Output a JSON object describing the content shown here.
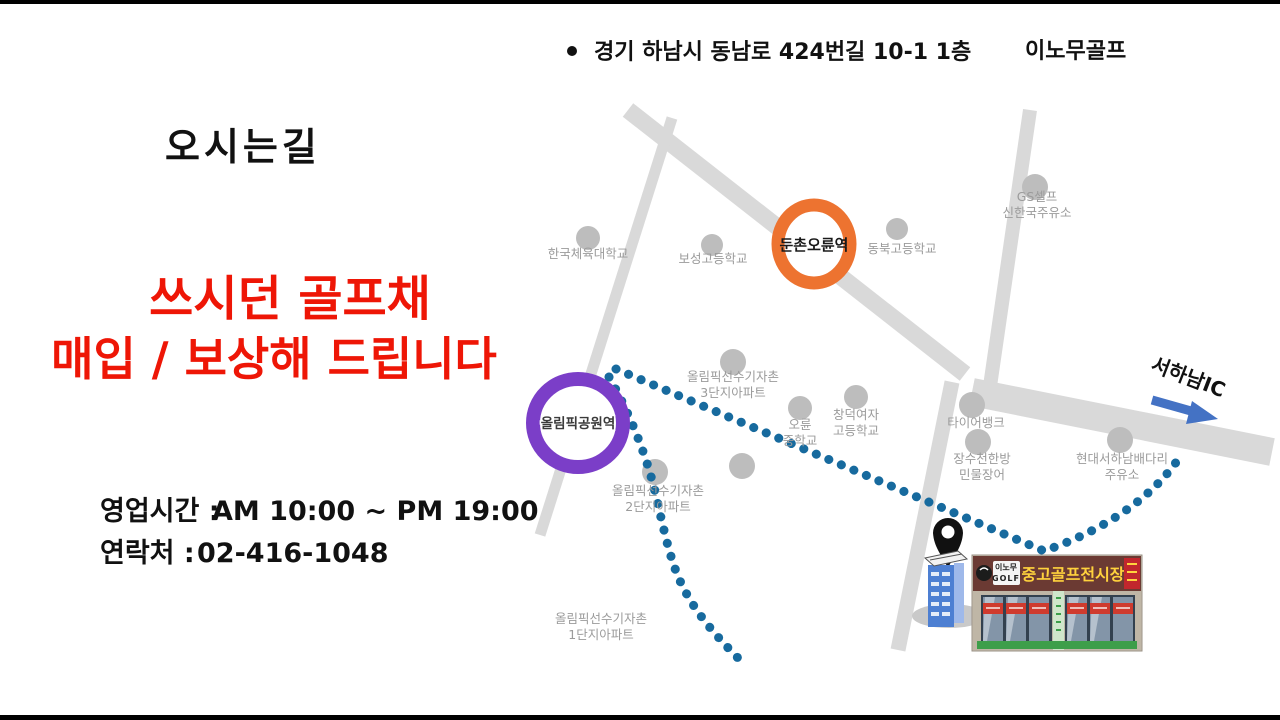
{
  "address": {
    "text": "경기 하남시 동남로 424번길 10-1 1층",
    "brand": "이노무골프"
  },
  "title": "오시는길",
  "promo": {
    "line1": "쓰시던 골프채",
    "line2": "매입 / 보상해 드립니다",
    "color": "#ee1606"
  },
  "info": {
    "hours_label": "영업시간 :",
    "hours_value": "AM 10:00 ~ PM 19:00",
    "contact_label": "연락처 :",
    "contact_value": "02-416-1048"
  },
  "map": {
    "road_color": "#d9d9d9",
    "poi_dot_color": "#bdbdbd",
    "route_color": "#176a9e",
    "stations": [
      {
        "name": "둔촌오륜역",
        "ring_color": "#ed7330"
      },
      {
        "name": "올림픽공원역",
        "ring_color": "#7b3ec8"
      }
    ],
    "labels": [
      {
        "line1": "한국체육대학교"
      },
      {
        "line1": "보성고등학교"
      },
      {
        "line1": "동북고등학교"
      },
      {
        "line1": "GS셀프",
        "line2": "신한국주유소"
      },
      {
        "line1": "올림픽선수기자촌",
        "line2": "3단지아파트"
      },
      {
        "line1": "오륜",
        "line2": "중학교"
      },
      {
        "line1": "창덕여자",
        "line2": "고등학교"
      },
      {
        "line1": "타이어뱅크"
      },
      {
        "line1": "장수천한방",
        "line2": "민물장어"
      },
      {
        "line1": "현대서하남배다리",
        "line2": "주유소"
      },
      {
        "line1": "올림픽선수기자촌",
        "line2": "2단지아파트"
      },
      {
        "line1": "올림픽선수기자촌",
        "line2": "1단지아파트"
      }
    ],
    "ic": {
      "label": "서하남IC",
      "arrow_color": "#4472c4"
    }
  },
  "store": {
    "logo_line1": "이노무",
    "logo_line2": "GOLF",
    "sign_text": "중고골프전시장",
    "sign_bg": "#6b3a33",
    "sign_text_color": "#ffd23d"
  }
}
